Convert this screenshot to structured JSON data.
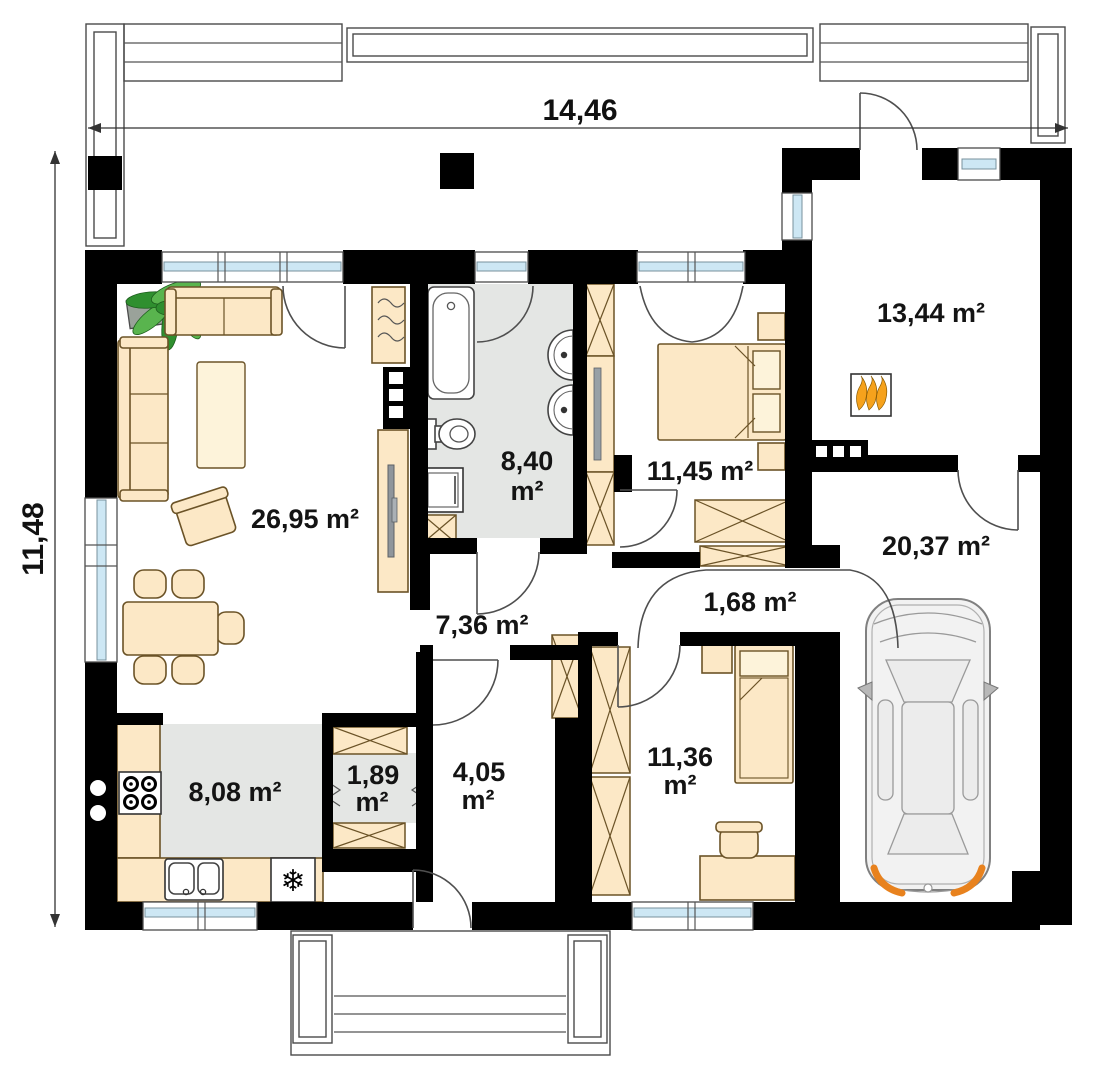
{
  "plan": {
    "dimensions": {
      "width": "14,46",
      "height": "11,48"
    },
    "rooms": {
      "living": {
        "label": "26,95 m²"
      },
      "bathroom": {
        "l1": "8,40",
        "l2": "m²"
      },
      "bedroom_top": {
        "label": "11,45 m²"
      },
      "utility": {
        "label": "13,44 m²"
      },
      "garage": {
        "label": "20,37 m²"
      },
      "closet": {
        "label": "1,68 m²"
      },
      "hall": {
        "label": "7,36 m²"
      },
      "kitchen": {
        "label": "8,08 m²"
      },
      "pantry": {
        "l1": "1,89",
        "l2": "m²"
      },
      "entry": {
        "l1": "4,05",
        "l2": "m²"
      },
      "bedroom_bottom": {
        "l1": "11,36",
        "l2": "m²"
      }
    },
    "icons": {
      "fridge": "❄",
      "fireplace": "flames",
      "stove": "four-burners",
      "plant": "potted-plant",
      "car": "car-top-view"
    },
    "colors": {
      "wall": "#000000",
      "furniture_fill": "#fce8c6",
      "furniture_stroke": "#6b5327",
      "floor_tile": "#e4e6e4",
      "window_glass": "#cde7f4",
      "flame": "#f6a21c",
      "car_body": "#f2f2f2",
      "car_taillight": "#e8821e"
    }
  }
}
